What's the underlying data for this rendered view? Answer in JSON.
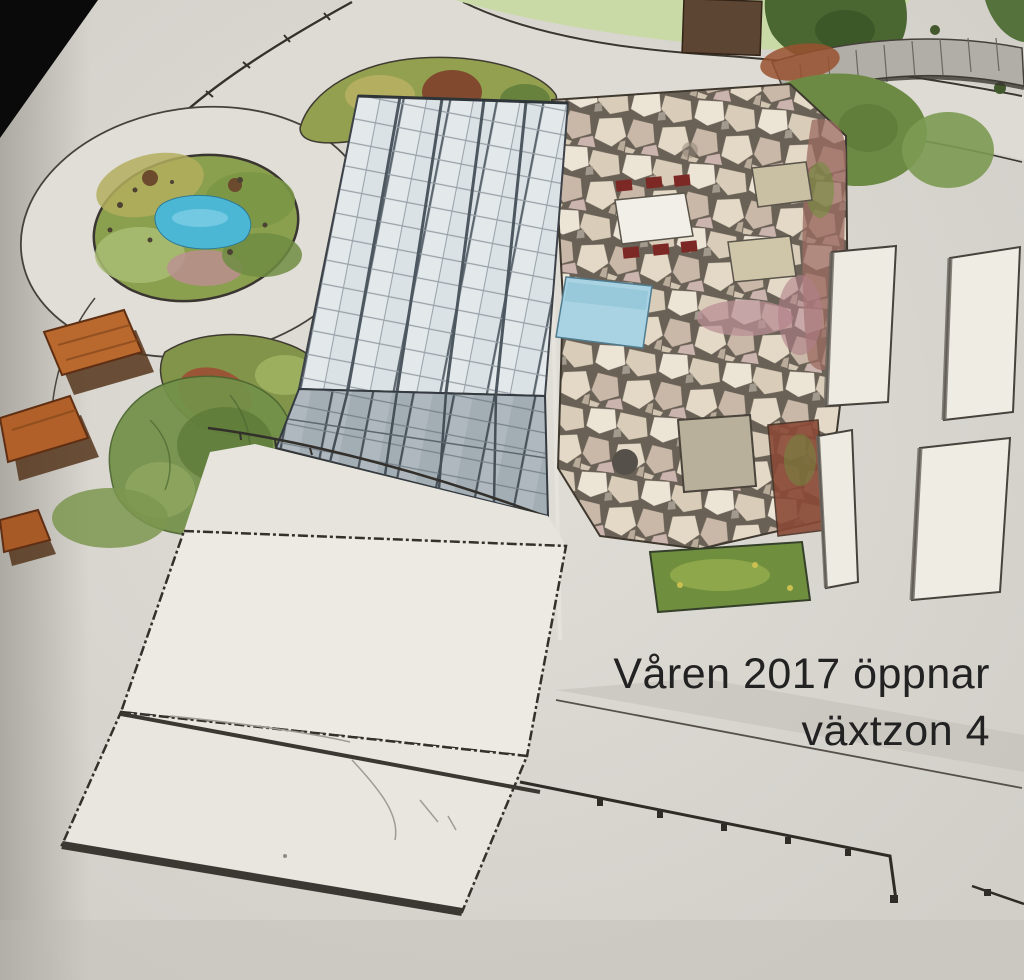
{
  "scene": {
    "description": "hand-drawn landscape architecture plan, watercolor and ink, photographed",
    "caption": {
      "line1": "Våren 2017 öppnar",
      "line2": "växtzon 4"
    }
  },
  "palette": {
    "paper": "#d2cfc9",
    "ink": "#35312c",
    "text_ink": "#222222",
    "road": "#dedbd4",
    "lawn_green": "#c9daa6",
    "canopy_green": "#74914a",
    "island_green": "#8aa04e",
    "pond_blue": "#4cb6d5",
    "pool_blue": "#a9d3e2",
    "glass_roof": "#e3e8eb",
    "glass_wall": "#aeb8be",
    "stone_joint": "#6a6156",
    "table_beige": "#c9c0a4",
    "table_white": "#f2efe8",
    "chair_red": "#7c2824",
    "planter_orange": "#b9692e",
    "hedge_green": "#6f8f3e",
    "slab_white": "#eeebe3",
    "field_white": "#eceae3",
    "wall_grey": "#b0aea6"
  },
  "features": [
    "curved-entry-road",
    "loop-path",
    "island-flowerbed-with-pond",
    "greenhouse-glass-roof",
    "greenhouse-glass-wall",
    "flagstone-patio",
    "patio-tables-and-chairs",
    "garden-pool",
    "stone-wall",
    "lawn",
    "trees-and-shrubs",
    "wooden-planter-boxes",
    "white-garden-slabs",
    "event-field",
    "boardwalk-edge",
    "caption-text"
  ]
}
